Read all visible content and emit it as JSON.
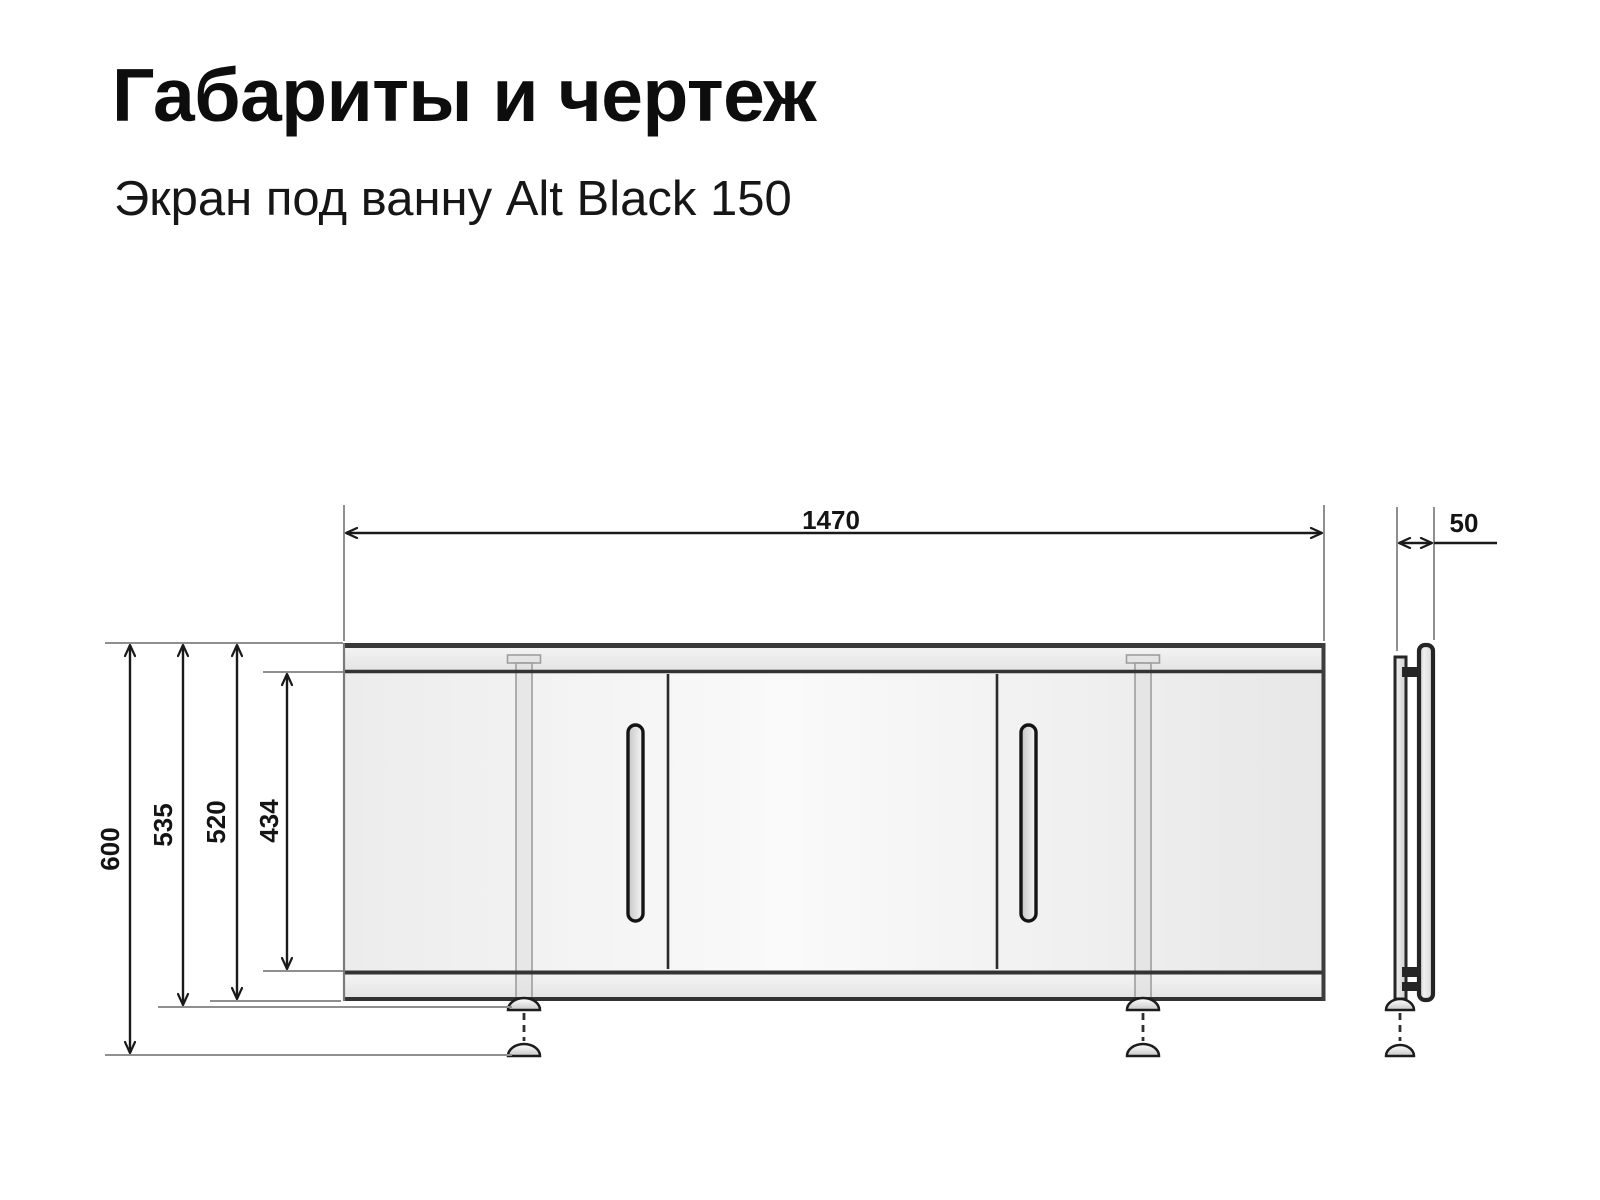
{
  "page": {
    "title": "Габариты и чертеж",
    "subtitle": "Экран под ванну Alt Black 150"
  },
  "dimensions_mm": {
    "width": "1470",
    "depth": "50",
    "total_height_feet_extended": "600",
    "height_with_feet": "535",
    "panel_height": "520",
    "inner_panel_height": "434"
  },
  "colors": {
    "background": "#ffffff",
    "outline_dark": "#333333",
    "dimension_line": "#1a1a1a",
    "extension_line": "#8f8f8f",
    "text": "#141414",
    "panel_fill_light": "#fafafa",
    "panel_fill_shade": "#e7e7e7"
  }
}
